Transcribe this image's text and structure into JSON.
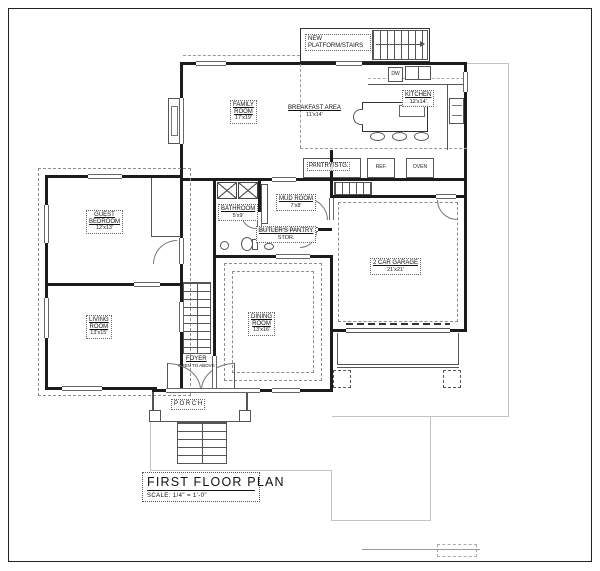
{
  "drawing": {
    "title": "FIRST FLOOR PLAN",
    "scale": "SCALE:  1/4\" = 1'-0\""
  },
  "rooms": {
    "platform": {
      "line1": "NEW",
      "line2": "PLATFORM/STAIRS"
    },
    "family": {
      "name": "FAMILY",
      "name2": "ROOM",
      "dim": "17'x19'"
    },
    "breakfast": {
      "name": "BREAKFAST AREA",
      "dim": "11'x14'"
    },
    "kitchen": {
      "name": "KITCHEN",
      "dim": "12'x14'"
    },
    "mud": {
      "name": "MUD ROOM",
      "dim": "7'x8'"
    },
    "bath": {
      "name": "BATHROOM",
      "dim": "5'x9'"
    },
    "butlers": {
      "name": "BUTLER'S PANTRY",
      "dim": "STOR."
    },
    "guest": {
      "name": "GUEST",
      "name2": "BEDROOM",
      "dim": "12'x13'"
    },
    "living": {
      "name": "LIVING",
      "name2": "ROOM",
      "dim": "13'x15'"
    },
    "dining": {
      "name": "DINING",
      "name2": "ROOM",
      "dim": "13'x16'"
    },
    "garage": {
      "name": "2 CAR GARAGE",
      "dim": "21'x21'"
    },
    "foyer": {
      "name": "FOYER",
      "sub": "OPEN TO ABOVE"
    },
    "porch": {
      "name": "P O R C H"
    }
  },
  "fixtures": {
    "pantry": "PANTRY/STG.",
    "ref": "REF.",
    "oven": "OVEN",
    "dw": "DW"
  }
}
